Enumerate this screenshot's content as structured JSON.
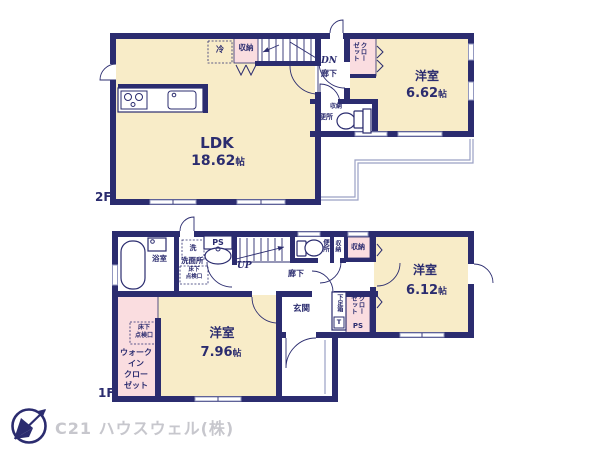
{
  "colors": {
    "wall": "#2b2c6f",
    "room_fill": "#f8ecc8",
    "closet_fill": "#fadde0",
    "thin_line": "#9aa0c4",
    "watermark": "#c7c7cd",
    "text": "#2b2c6f"
  },
  "watermark": {
    "company": "C21 ハウスウェル(株)"
  },
  "floor2": {
    "label": "2F",
    "ldk": {
      "name": "LDK",
      "num": "18.62",
      "unit": "帖"
    },
    "bedroom": {
      "name": "洋室",
      "num": "6.62",
      "unit": "帖"
    },
    "closet_label": "クローゼット",
    "storage_label": "収納",
    "fridge_label": "冷",
    "stairs_label": "DN",
    "hallway_label": "廊下",
    "toilet_label": "便所",
    "toilet_storage_label": "収納"
  },
  "floor1": {
    "label": "1F",
    "bath_label": "浴室",
    "washer_label": "洗",
    "washroom_label": "洗面所",
    "inspection_lines": [
      "床下",
      "点検口"
    ],
    "ps_label": "PS",
    "stairs_label": "UP",
    "hallway_label": "廊下",
    "toilet_label": "便所",
    "storage_strip_label": "収納",
    "storage_label": "収納",
    "bedroom1": {
      "name": "洋室",
      "num": "6.12",
      "unit": "帖"
    },
    "closet_label": "クローゼット",
    "closet_ps_label": "PS",
    "shoebox_label": "下足箱",
    "shoebox_t_label": "T",
    "entrance_label": "玄関",
    "wic_inspection_lines": [
      "床下",
      "点検口"
    ],
    "wic_lines": [
      "ウォーク",
      "イン",
      "クロー",
      "ゼット"
    ],
    "bedroom2": {
      "name": "洋室",
      "num": "7.96",
      "unit": "帖"
    }
  }
}
